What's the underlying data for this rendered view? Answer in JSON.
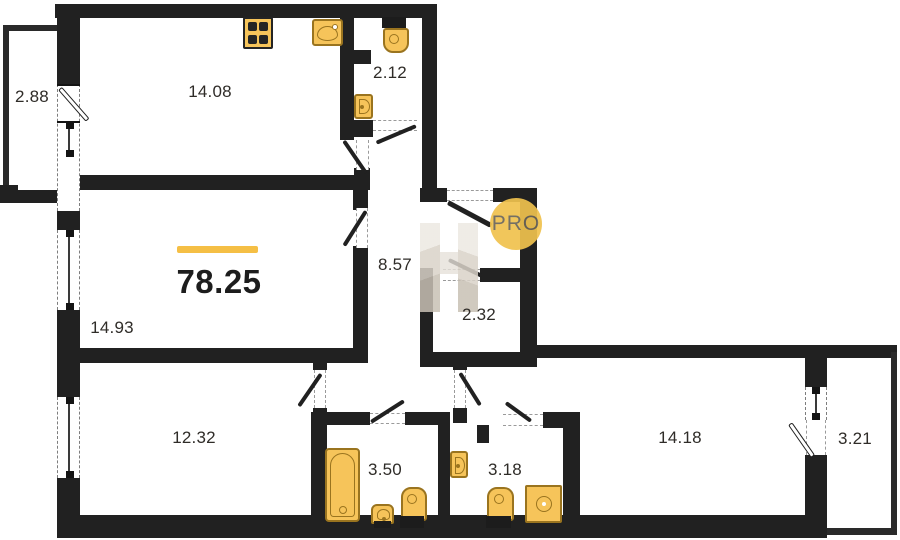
{
  "plan": {
    "type": "apartment-floor-plan",
    "total": {
      "value": "78.25",
      "accent_color": "#F5BF45"
    },
    "watermark": {
      "badge": "PRO",
      "badge_color": "#F0C24E",
      "logo": "developer-logo-monogram"
    },
    "rooms": [
      {
        "id": "balcony-left",
        "area": "2.88"
      },
      {
        "id": "kitchen",
        "area": "14.08"
      },
      {
        "id": "wc-top",
        "area": "2.12"
      },
      {
        "id": "hallway",
        "area": "8.57"
      },
      {
        "id": "living-room",
        "area": "14.93"
      },
      {
        "id": "storage",
        "area": "2.32"
      },
      {
        "id": "bedroom-left",
        "area": "12.32"
      },
      {
        "id": "bathroom",
        "area": "3.50"
      },
      {
        "id": "wc-bottom",
        "area": "3.18"
      },
      {
        "id": "bedroom-right",
        "area": "14.18"
      },
      {
        "id": "balcony-right",
        "area": "3.21"
      }
    ],
    "fixtures": [
      "stove-icon",
      "kitchen-sink-icon",
      "toilet-icon",
      "hand-sink-icon",
      "bathtub-icon",
      "washing-machine-icon"
    ],
    "colors": {
      "wall": "#212121",
      "fixture_fill": "#F6C45A",
      "fixture_border": "#9A741F",
      "label": "#2F2C28"
    }
  }
}
